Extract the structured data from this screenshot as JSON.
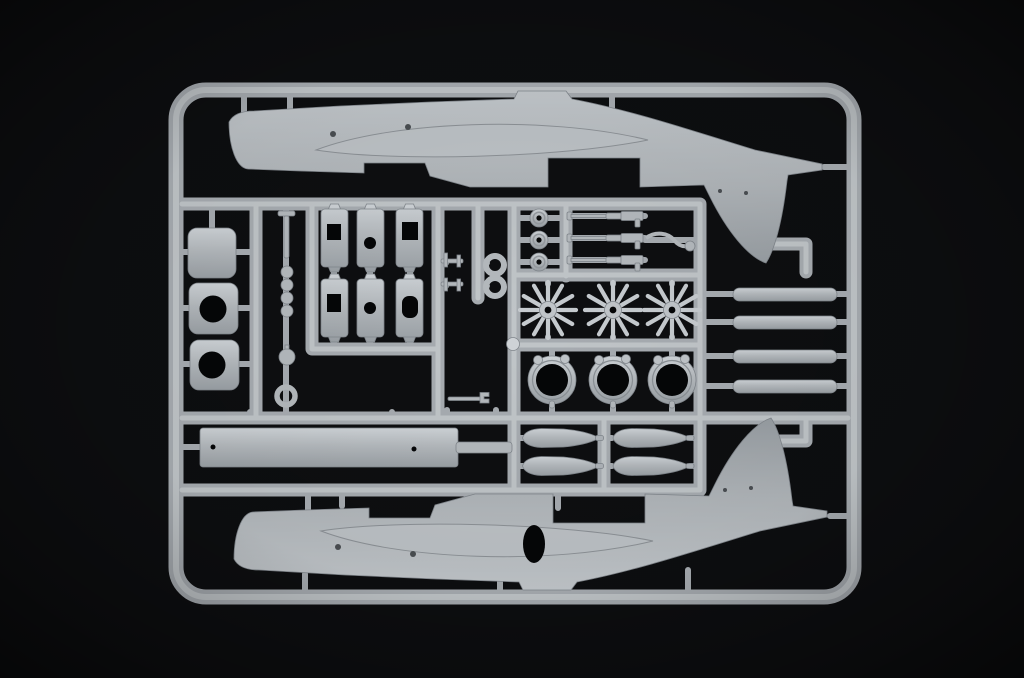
{
  "meta": {
    "description": "Photograph of an injection-molded grey styrene model aircraft sprue (parts tree) lying on a black background",
    "width_px": 1024,
    "height_px": 678
  },
  "colors": {
    "background": "#0d0e10",
    "hole": "#050607",
    "plastic_base": "#b4b9bd",
    "plastic_light": "#c6cbcf",
    "plastic_shadow": "#999fa4",
    "plastic_edge": "#80868c",
    "runner_base": "#a7acb1",
    "runner_core": "#c4c9cd",
    "panel_line": "#4a4e52"
  },
  "sprue": {
    "frame_shape": "rounded rectangular runner frame",
    "parts_inventory": [
      {
        "name": "fuselage-half-upper",
        "qty": 1,
        "desc": "aircraft fuselage half, nose left, tail fin pointing down"
      },
      {
        "name": "fuselage-half-lower",
        "qty": 1,
        "desc": "aircraft fuselage half, nose left, tail fin pointing up, open door oval"
      },
      {
        "name": "cowling-side-panel",
        "qty": 3,
        "desc": "curved rectangular panels, two with large round openings"
      },
      {
        "name": "bulkhead-plate",
        "qty": 6,
        "desc": "small rectangular plates with square / round cut-outs, 3 columns x 2 rows"
      },
      {
        "name": "radial-engine",
        "qty": 3,
        "desc": "star-shaped radial engine cylinder banks"
      },
      {
        "name": "cowling-ring",
        "qty": 3,
        "desc": "open engine cowl rings with small ear tabs"
      },
      {
        "name": "bomb-half",
        "qty": 4,
        "desc": "elongated bomb / tank halves in two stacked pairs"
      },
      {
        "name": "exhaust-strip",
        "qty": 4,
        "desc": "long rounded strips on the right side"
      },
      {
        "name": "floor-plank",
        "qty": 1,
        "desc": "long rectangular cabin floor with two locating holes"
      },
      {
        "name": "wheel",
        "qty": 3,
        "desc": "small discs with hub holes"
      },
      {
        "name": "machine-gun",
        "qty": 3,
        "desc": "slender barreled guns in a horizontal row"
      },
      {
        "name": "small-ring",
        "qty": 3,
        "desc": "small open rings"
      },
      {
        "name": "misc-small-parts",
        "qty": 10,
        "desc": "pins, beads, hub, brackets, wrench-shaped lever, bent rod, sprue ball"
      }
    ]
  }
}
